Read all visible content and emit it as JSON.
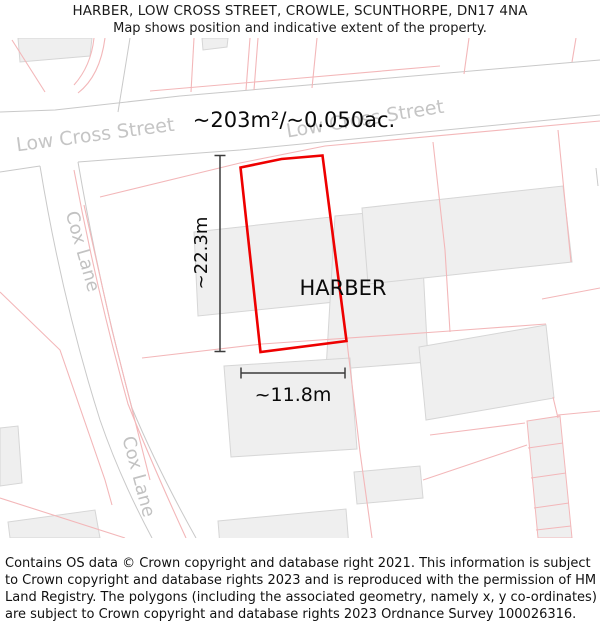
{
  "header": {
    "title": "HARBER, LOW CROSS STREET, CROWLE, SCUNTHORPE, DN17 4NA",
    "subtitle": "Map shows position and indicative extent of the property."
  },
  "map": {
    "property_name": "HARBER",
    "area_label": "~203m²/~0.050ac.",
    "dimensions": {
      "height": "~22.3m",
      "width": "~11.8m"
    },
    "streets": [
      {
        "name": "Low Cross Street"
      },
      {
        "name": "Low Cross Street"
      },
      {
        "name": "Cox Lane"
      },
      {
        "name": "Cox Lane"
      }
    ],
    "colors": {
      "property_outline": "#ee0000",
      "parcel_line": "#f3b7b9",
      "road_edge": "#c9c9c9",
      "building_fill": "#efefef",
      "building_stroke": "#d6d6d6",
      "street_label": "#c5c5c5",
      "dimension_line": "#3c3c3c"
    }
  },
  "footer": {
    "attribution": "Contains OS data © Crown copyright and database right 2021. This information is subject to Crown copyright and database rights 2023 and is reproduced with the permission of HM Land Registry. The polygons (including the associated geometry, namely x, y co-ordinates) are subject to Crown copyright and database rights 2023 Ordnance Survey 100026316."
  }
}
